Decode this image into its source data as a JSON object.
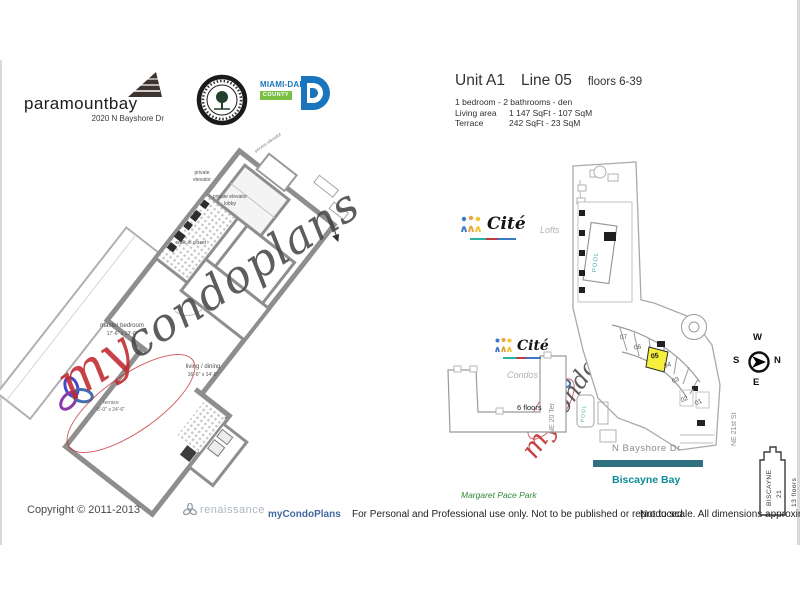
{
  "header": {
    "brand": "paramountbay",
    "address": "2020 N Bayshore Dr",
    "county_name": "MIAMI-DADE",
    "county_sub": "COUNTY"
  },
  "unit": {
    "unit": "Unit A1",
    "line": "Line 05",
    "floors": "floors 6-39",
    "description": "1 bedroom - 2 bathrooms - den",
    "living_label": "Living area",
    "living_value": "1 147 SqFt - 107 SqM",
    "terrace_label": "Terrace",
    "terrace_value": "242 SqFt -  23 SqM"
  },
  "plan": {
    "private_elevator": "private elevator",
    "lobby": "private elevator lobby",
    "closet": "walk-in closet",
    "master": "master bedroom",
    "master_dims": "17'-6\" x 13'-0\"",
    "living": "living / dining",
    "living_dims": "16'-6\" x 14'-0\"",
    "terrace": "terrace",
    "terrace_dims": "8'-0\" x 24'-6\"",
    "service": "service elevator"
  },
  "map": {
    "lofts_brand": "Cité",
    "lofts_label": "Lofts",
    "condos_brand": "Cité",
    "condos_label": "Condos",
    "condos_floors": "6 floors",
    "pool": "POOL",
    "units": [
      "07",
      "06",
      "05",
      "04",
      "03",
      "02",
      "01"
    ],
    "highlighted_unit": "05",
    "road_left": "NE 20 Ter",
    "road_right": "NE 21st St",
    "road_bottom": "N Bayshore Dr",
    "bay": "Biscayne Bay",
    "park": "Margaret Pace Park",
    "compass": {
      "n": "N",
      "s": "S",
      "e": "E",
      "w": "W"
    },
    "b21_name": "BISCAYNE",
    "b21_num": "21",
    "b21_floors": "13 floors"
  },
  "wm": {
    "my": "my",
    "rest": "condoplans"
  },
  "footer": {
    "copyright": "Copyright © 2011-2013",
    "renaissance": "renaissance",
    "brand": "myCondoPlans",
    "usage": "For Personal and Professional use only.  Not to be published or reproduced.",
    "note": "Not to scale.  All dimensions approximate."
  },
  "colors": {
    "highlight_yellow": "#f5ee3d",
    "county_blue": "#1b75bc",
    "county_green": "#7ac143",
    "bay_bar_teal": "#2e6f82",
    "bay_text_teal": "#0d8c96",
    "pool_teal": "#45b0a8",
    "park_green": "#2e8b33",
    "watermark_red": "#c1272d",
    "wall_gray": "#8e8e8e"
  }
}
